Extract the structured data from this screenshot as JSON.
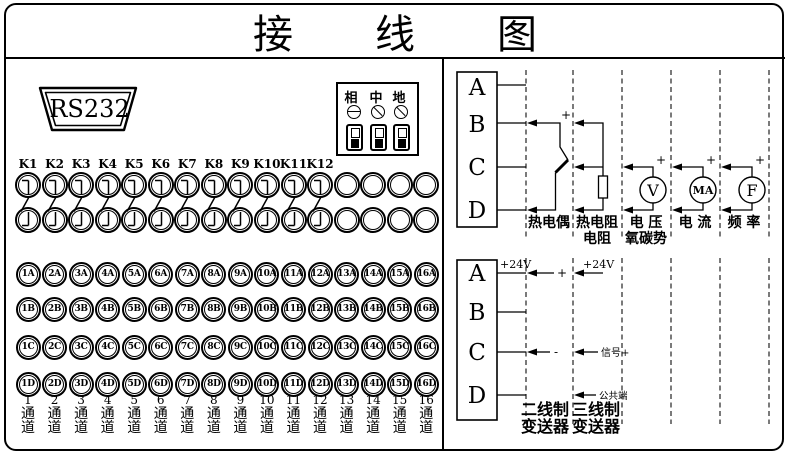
{
  "title_chars": [
    "接",
    "线",
    "图"
  ],
  "left": {
    "rs232_label": "RS232",
    "power": {
      "phase": "相",
      "neutral": "中",
      "earth": "地"
    },
    "relay_labels": [
      "K1",
      "K2",
      "K3",
      "K4",
      "K5",
      "K6",
      "K7",
      "K8",
      "K9",
      "K10",
      "K11",
      "K12"
    ],
    "relay_columns": 16,
    "terminal_rows": [
      [
        "1A",
        "2A",
        "3A",
        "4A",
        "5A",
        "6A",
        "7A",
        "8A",
        "9A",
        "10A",
        "11A",
        "12A",
        "13A",
        "14A",
        "15A",
        "16A"
      ],
      [
        "1B",
        "2B",
        "3B",
        "4B",
        "5B",
        "6B",
        "7B",
        "8B",
        "9B",
        "10B",
        "11B",
        "12B",
        "13B",
        "14B",
        "15B",
        "16B"
      ],
      [
        "1C",
        "2C",
        "3C",
        "4C",
        "5C",
        "6C",
        "7C",
        "8C",
        "9C",
        "10C",
        "11C",
        "12C",
        "13C",
        "14C",
        "15C",
        "16C"
      ],
      [
        "1D",
        "2D",
        "3D",
        "4D",
        "5D",
        "6D",
        "7D",
        "8D",
        "9D",
        "10D",
        "11D",
        "12D",
        "13D",
        "14D",
        "15D",
        "16D"
      ]
    ],
    "channels": {
      "numbers": [
        "1",
        "2",
        "3",
        "4",
        "5",
        "6",
        "7",
        "8",
        "9",
        "10",
        "11",
        "12",
        "13",
        "14",
        "15",
        "16"
      ],
      "chars": [
        "通",
        "道"
      ]
    }
  },
  "right_top": {
    "terminals": [
      "A",
      "B",
      "C",
      "D"
    ],
    "signs": {
      "plus": "+",
      "minus": "-"
    },
    "meters": {
      "voltage": "V",
      "current": "MA",
      "frequency": "F"
    },
    "columns": [
      {
        "lines": [
          "热电偶"
        ]
      },
      {
        "lines": [
          "热电阻",
          "电阻"
        ]
      },
      {
        "lines": [
          "电 压",
          "氧碳势"
        ]
      },
      {
        "lines": [
          "电 流"
        ]
      },
      {
        "lines": [
          "频 率"
        ]
      }
    ]
  },
  "right_bottom": {
    "terminals": [
      "A",
      "B",
      "C",
      "D"
    ],
    "labels": {
      "v24_box": "+24V",
      "plus": "+",
      "v24_col2": "+24V",
      "minus": "-",
      "signal": "信号+",
      "common": "公共端"
    },
    "columns": [
      {
        "lines": [
          "二线制",
          "变送器"
        ]
      },
      {
        "lines": [
          "三线制",
          "变送器"
        ]
      }
    ]
  }
}
